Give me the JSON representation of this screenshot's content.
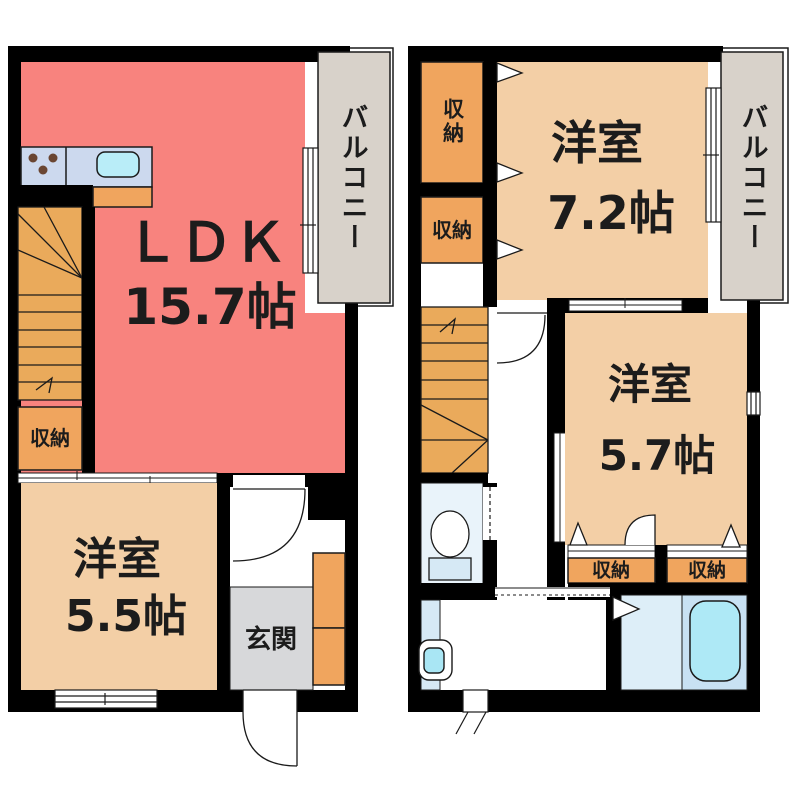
{
  "document_type": "floor-plan",
  "colors": {
    "wall": "#000000",
    "ldk": "#f8837e",
    "bedroom": "#f3cfa6",
    "closet": "#f0a55e",
    "stairs": "#eaaa5b",
    "balcony": "#d8d2ca",
    "entrance": "#d7d8da",
    "toilet_room": "#e9f3fa",
    "bath_wash": "#ddeef8",
    "bath_tub_area": "#c8e1f3",
    "tub": "#aee9f6",
    "kitchen_counter": "#ccd9ee",
    "sink": "#b9edf8",
    "vanity": "#d6e9f5",
    "basin": "#a9e6f4",
    "burner": "#6a4632"
  },
  "floor1": {
    "ldk_label": "ＬＤＫ",
    "ldk_area": "15.7帖",
    "bedroom_label": "洋室",
    "bedroom_area": "5.5帖",
    "closet_label": "収納",
    "entrance_label": "玄関",
    "balcony_label": "バルコニー"
  },
  "floor2": {
    "bedroom1_label": "洋室",
    "bedroom1_area": "7.2帖",
    "bedroom2_label": "洋室",
    "bedroom2_area": "5.7帖",
    "closet_top_label": "収納",
    "closet_mid_label": "収納",
    "closet_left_label": "収納",
    "closet_right_label": "収納",
    "balcony_label": "バルコニー"
  }
}
